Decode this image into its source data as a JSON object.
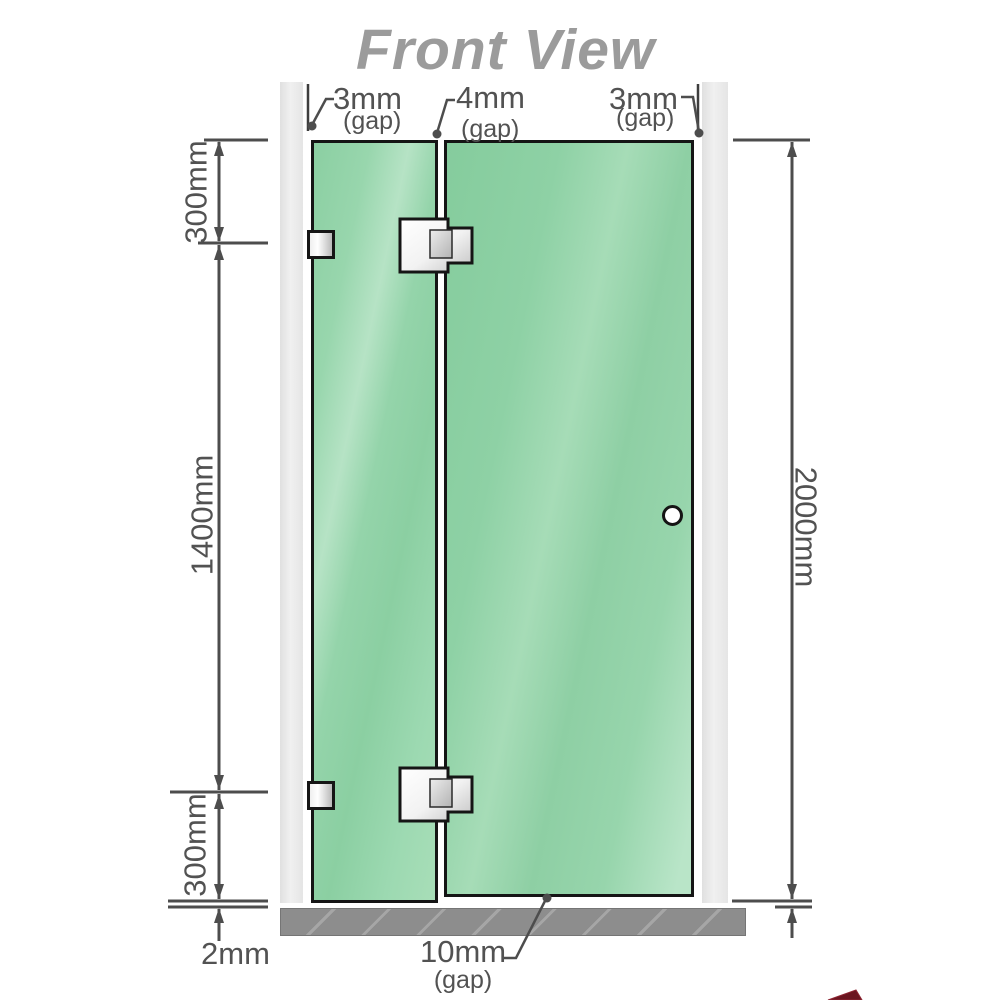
{
  "title": "Front View",
  "annotations": {
    "gap_left": {
      "value": "3mm",
      "suffix": "(gap)"
    },
    "gap_center": {
      "value": "4mm",
      "suffix": "(gap)"
    },
    "gap_right": {
      "value": "3mm",
      "suffix": "(gap)"
    },
    "gap_bottom": {
      "value": "10mm",
      "suffix": "(gap)"
    },
    "gap_floor": {
      "value": "2mm"
    }
  },
  "dimensions": {
    "left_top": "300mm",
    "left_middle": "1400mm",
    "left_bottom": "300mm",
    "right_total": "2000mm"
  },
  "colors": {
    "glass_green": "#8ecfa4",
    "glass_highlight": "#b7e4c6",
    "frame_black": "#151515",
    "wall_channel_gray": "#eaeaea",
    "base_gray": "#8d8d8d",
    "dimension_gray": "#4d4d4d",
    "label_gray": "#525252",
    "title_gray": "#9b9b9b",
    "logo_accent": "#6b1520"
  }
}
